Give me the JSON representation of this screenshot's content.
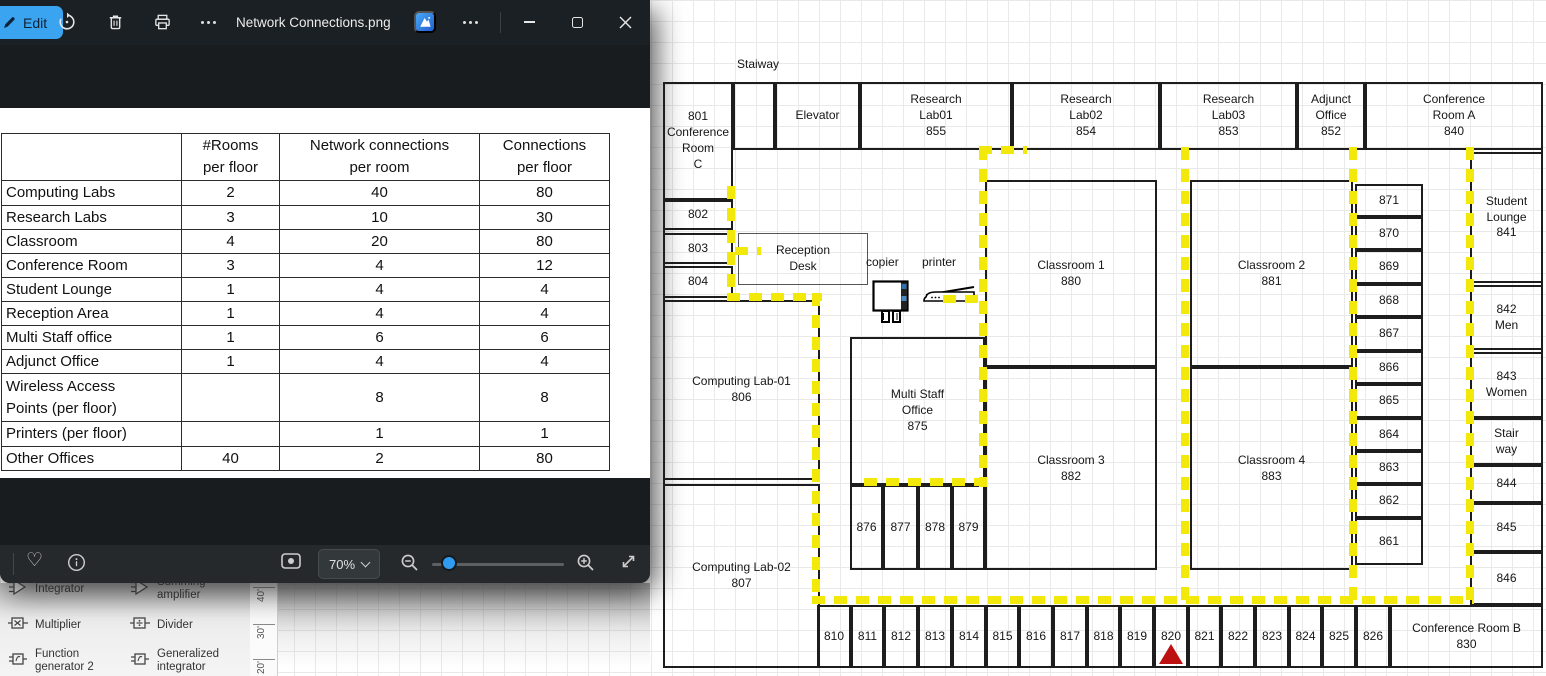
{
  "photos": {
    "title": "Network Connections.png",
    "titlebar": {
      "edit_label": "Edit",
      "left_icons": [
        "edit-pen",
        "rotate",
        "delete",
        "print",
        "more"
      ],
      "right_icons": [
        "designer",
        "more",
        "minimize",
        "maximize",
        "close"
      ]
    },
    "table": {
      "headers": [
        "",
        "#Rooms\nper floor",
        "Network connections\nper room",
        "Connections\nper floor"
      ],
      "rows": [
        [
          "Computing Labs",
          "2",
          "40",
          "80"
        ],
        [
          "Research Labs",
          "3",
          "10",
          "30"
        ],
        [
          "Classroom",
          "4",
          "20",
          "80"
        ],
        [
          "Conference Room",
          "3",
          "4",
          "12"
        ],
        [
          "Student Lounge",
          "1",
          "4",
          "4"
        ],
        [
          "Reception Area",
          "1",
          "4",
          "4"
        ],
        [
          "Multi Staff office",
          "1",
          "6",
          "6"
        ],
        [
          "Adjunct Office",
          "1",
          "4",
          "4"
        ],
        [
          "Wireless Access\nPoints (per floor)",
          "",
          "8",
          "8"
        ],
        [
          "Printers (per floor)",
          "",
          "1",
          "1"
        ],
        [
          "Other Offices",
          "40",
          "2",
          "80"
        ]
      ]
    },
    "bottom_bar": {
      "zoom_level": "70%",
      "icons": [
        "favorite-heart",
        "info",
        "frame",
        "zoom-out",
        "zoom-slider",
        "zoom-in",
        "fullscreen"
      ]
    }
  },
  "visio": {
    "stencil_items": [
      {
        "icon": "op-triangle",
        "label": "Integrator"
      },
      {
        "icon": "op-triangle",
        "label": "Summing amplifier"
      },
      {
        "icon": "box-x",
        "label": "Multiplier"
      },
      {
        "icon": "box-div",
        "label": "Divider"
      },
      {
        "icon": "box-fn",
        "label": "Function generator 2"
      },
      {
        "icon": "box-fn",
        "label": "Generalized integrator"
      }
    ],
    "ruler_marks": [
      "40'",
      "30'",
      "20'"
    ],
    "floor_plan": {
      "wall_color": "#1d1d1d",
      "cable_color": "#f2e90a",
      "marker_color": "#bd1111",
      "free_labels": [
        {
          "text": "Staiway",
          "x": 737,
          "y": 57
        },
        {
          "text": "copier",
          "x": 866,
          "y": 255
        },
        {
          "text": "printer",
          "x": 922,
          "y": 255
        }
      ],
      "rooms": [
        {
          "label": "",
          "x": 663,
          "y": 82,
          "w": 880,
          "h": 586,
          "outer": true
        },
        {
          "label": "801\nConference\nRoom\nC",
          "x": 663,
          "y": 82,
          "w": 70,
          "h": 118
        },
        {
          "label": "",
          "x": 733,
          "y": 82,
          "w": 42,
          "h": 68
        },
        {
          "label": "Elevator",
          "x": 775,
          "y": 82,
          "w": 85,
          "h": 68
        },
        {
          "label": "Research\nLab01\n855",
          "x": 860,
          "y": 82,
          "w": 152,
          "h": 68
        },
        {
          "label": "Research\nLab02\n854",
          "x": 1012,
          "y": 82,
          "w": 148,
          "h": 68
        },
        {
          "label": "Research\nLab03\n853",
          "x": 1160,
          "y": 82,
          "w": 137,
          "h": 68
        },
        {
          "label": "Adjunct\nOffice\n852",
          "x": 1297,
          "y": 82,
          "w": 68,
          "h": 68
        },
        {
          "label": "Conference\nRoom A\n840",
          "x": 1365,
          "y": 82,
          "w": 178,
          "h": 68
        },
        {
          "label": "802",
          "x": 663,
          "y": 200,
          "w": 70,
          "h": 30
        },
        {
          "label": "803",
          "x": 663,
          "y": 233,
          "w": 70,
          "h": 31
        },
        {
          "label": "804",
          "x": 663,
          "y": 266,
          "w": 70,
          "h": 32
        },
        {
          "label": "Computing Lab-01\n806",
          "x": 663,
          "y": 300,
          "w": 157,
          "h": 180
        },
        {
          "label": "Computing Lab-02\n807",
          "x": 663,
          "y": 484,
          "w": 157,
          "h": 184
        },
        {
          "label": "Reception\nDesk",
          "x": 738,
          "y": 233,
          "w": 130,
          "h": 52,
          "thin": true
        },
        {
          "label": "Multi Staff\nOffice\n875",
          "x": 850,
          "y": 337,
          "w": 135,
          "h": 148
        },
        {
          "label": "876",
          "x": 850,
          "y": 485,
          "w": 33,
          "h": 85
        },
        {
          "label": "877",
          "x": 883,
          "y": 485,
          "w": 35,
          "h": 85
        },
        {
          "label": "878",
          "x": 918,
          "y": 485,
          "w": 34,
          "h": 85
        },
        {
          "label": "879",
          "x": 952,
          "y": 485,
          "w": 33,
          "h": 85
        },
        {
          "label": "Classroom 1\n880",
          "x": 985,
          "y": 180,
          "w": 172,
          "h": 187
        },
        {
          "label": "Classroom 3\n882",
          "x": 985,
          "y": 367,
          "w": 172,
          "h": 203
        },
        {
          "label": "Classroom 2\n881",
          "x": 1190,
          "y": 180,
          "w": 163,
          "h": 187
        },
        {
          "label": "Classroom 4\n883",
          "x": 1190,
          "y": 367,
          "w": 163,
          "h": 203
        },
        {
          "label": "871",
          "x": 1355,
          "y": 184,
          "w": 68,
          "h": 33
        },
        {
          "label": "870",
          "x": 1355,
          "y": 217,
          "w": 68,
          "h": 33
        },
        {
          "label": "869",
          "x": 1355,
          "y": 250,
          "w": 68,
          "h": 34
        },
        {
          "label": "868",
          "x": 1355,
          "y": 284,
          "w": 68,
          "h": 33
        },
        {
          "label": "867",
          "x": 1355,
          "y": 317,
          "w": 68,
          "h": 34
        },
        {
          "label": "866",
          "x": 1355,
          "y": 351,
          "w": 68,
          "h": 33
        },
        {
          "label": "865",
          "x": 1355,
          "y": 384,
          "w": 68,
          "h": 34
        },
        {
          "label": "864",
          "x": 1355,
          "y": 418,
          "w": 68,
          "h": 33
        },
        {
          "label": "863",
          "x": 1355,
          "y": 451,
          "w": 68,
          "h": 33
        },
        {
          "label": "862",
          "x": 1355,
          "y": 484,
          "w": 68,
          "h": 34
        },
        {
          "label": "861",
          "x": 1355,
          "y": 518,
          "w": 68,
          "h": 47
        },
        {
          "label": "Student\nLounge\n841",
          "x": 1470,
          "y": 152,
          "w": 73,
          "h": 131
        },
        {
          "label": "842\nMen",
          "x": 1470,
          "y": 285,
          "w": 73,
          "h": 65
        },
        {
          "label": "843\nWomen",
          "x": 1470,
          "y": 352,
          "w": 73,
          "h": 66
        },
        {
          "label": "Stair\nway",
          "x": 1470,
          "y": 418,
          "w": 73,
          "h": 47
        },
        {
          "label": "844",
          "x": 1470,
          "y": 465,
          "w": 73,
          "h": 38
        },
        {
          "label": "845",
          "x": 1470,
          "y": 503,
          "w": 73,
          "h": 49
        },
        {
          "label": "846",
          "x": 1470,
          "y": 552,
          "w": 73,
          "h": 53
        },
        {
          "label": "810",
          "x": 817,
          "y": 605,
          "w": 34,
          "h": 63
        },
        {
          "label": "811",
          "x": 851,
          "y": 605,
          "w": 33,
          "h": 63
        },
        {
          "label": "812",
          "x": 884,
          "y": 605,
          "w": 34,
          "h": 63
        },
        {
          "label": "813",
          "x": 918,
          "y": 605,
          "w": 34,
          "h": 63
        },
        {
          "label": "814",
          "x": 952,
          "y": 605,
          "w": 34,
          "h": 63
        },
        {
          "label": "815",
          "x": 986,
          "y": 605,
          "w": 33,
          "h": 63
        },
        {
          "label": "816",
          "x": 1019,
          "y": 605,
          "w": 34,
          "h": 63
        },
        {
          "label": "817",
          "x": 1053,
          "y": 605,
          "w": 34,
          "h": 63
        },
        {
          "label": "818",
          "x": 1087,
          "y": 605,
          "w": 33,
          "h": 63
        },
        {
          "label": "819",
          "x": 1120,
          "y": 605,
          "w": 34,
          "h": 63
        },
        {
          "label": "820",
          "x": 1154,
          "y": 605,
          "w": 34,
          "h": 63
        },
        {
          "label": "821",
          "x": 1188,
          "y": 605,
          "w": 33,
          "h": 63
        },
        {
          "label": "822",
          "x": 1221,
          "y": 605,
          "w": 34,
          "h": 63
        },
        {
          "label": "823",
          "x": 1255,
          "y": 605,
          "w": 34,
          "h": 63
        },
        {
          "label": "824",
          "x": 1289,
          "y": 605,
          "w": 33,
          "h": 63
        },
        {
          "label": "825",
          "x": 1322,
          "y": 605,
          "w": 34,
          "h": 63
        },
        {
          "label": "826",
          "x": 1356,
          "y": 605,
          "w": 34,
          "h": 63
        },
        {
          "label": "Conference Room B\n830",
          "x": 1390,
          "y": 605,
          "w": 153,
          "h": 63
        }
      ],
      "cable_segments": [
        {
          "x": 727,
          "y": 186,
          "w": 8,
          "h": 114
        },
        {
          "x": 727,
          "y": 293,
          "w": 95,
          "h": 8
        },
        {
          "x": 735,
          "y": 247,
          "w": 26,
          "h": 8
        },
        {
          "x": 812,
          "y": 293,
          "w": 8,
          "h": 311
        },
        {
          "x": 812,
          "y": 596,
          "w": 662,
          "h": 8
        },
        {
          "x": 979,
          "y": 147,
          "w": 8,
          "h": 340
        },
        {
          "x": 864,
          "y": 478,
          "w": 123,
          "h": 8
        },
        {
          "x": 979,
          "y": 146,
          "w": 48,
          "h": 8
        },
        {
          "x": 943,
          "y": 295,
          "w": 42,
          "h": 8
        },
        {
          "x": 1181,
          "y": 147,
          "w": 8,
          "h": 457
        },
        {
          "x": 1349,
          "y": 147,
          "w": 8,
          "h": 457
        },
        {
          "x": 1466,
          "y": 147,
          "w": 8,
          "h": 457
        }
      ],
      "marker": {
        "room": "820",
        "x": 1159,
        "y": 644
      }
    }
  }
}
